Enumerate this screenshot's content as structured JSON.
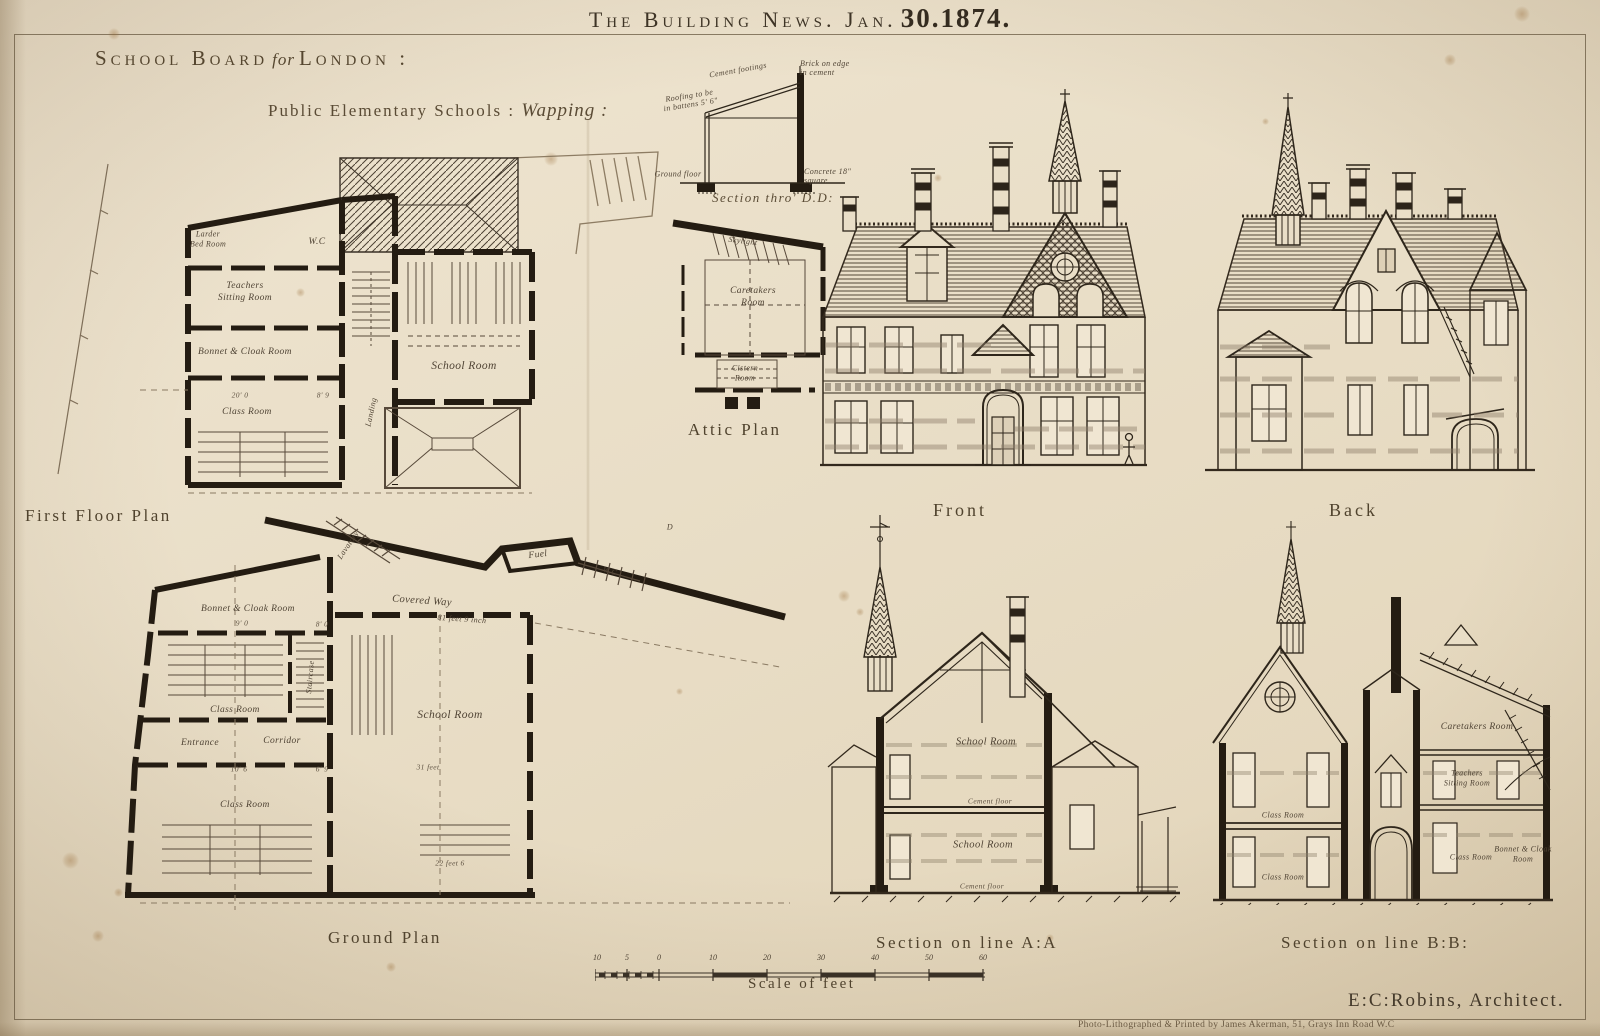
{
  "masthead": {
    "title": "The Building News. Jan.",
    "date": "30.1874."
  },
  "header": {
    "board": "School Board",
    "for_word": "for",
    "city": "London :",
    "schools": "Public Elementary Schools :",
    "place": "Wapping :"
  },
  "first_floor": {
    "caption": "First Floor Plan",
    "rooms": {
      "larder1": "Larder",
      "larder2": "Bed Room",
      "wc": "W.C",
      "teachers1": "Teachers",
      "teachers2": "Sitting Room",
      "bonnet": "Bonnet & Cloak Room",
      "landing": "Landing",
      "school": "School Room",
      "class_room": "Class Room"
    },
    "dims": [
      "20' 0",
      "8' 9"
    ]
  },
  "section_dd": {
    "caption": "Section thro' D.D:",
    "ann_roofing": "Roofing to be in battens 5' 6\"",
    "ann_cement": "Cement footings",
    "ann_brick": "Brick on edge in cement",
    "ann_concrete": "Concrete 18\" square",
    "ann_ground": "Ground floor"
  },
  "attic": {
    "caption": "Attic Plan",
    "rooms": {
      "skylight": "Skylight",
      "caretakers1": "Caretakers",
      "caretakers2": "Room",
      "cistern1": "Cistern",
      "cistern2": "Room"
    }
  },
  "front": {
    "caption": "Front"
  },
  "back": {
    "caption": "Back"
  },
  "ground": {
    "caption": "Ground Plan",
    "rooms": {
      "lavatory": "Lavatory",
      "fuel": "Fuel",
      "wc": "W.C",
      "covered_way": "Covered Way",
      "covered_dim": "81 feet 9 inch",
      "bonnet": "Bonnet & Cloak Room",
      "class_upper": "Class Room",
      "staircase": "Staircase",
      "entrance": "Entrance",
      "corridor": "Corridor",
      "school": "School Room",
      "class_lower": "Class Room",
      "door_marker": "D"
    },
    "dims": [
      "9' 0",
      "8' 0",
      "10' 6",
      "6' 9",
      "31 feet",
      "22 feet 6"
    ]
  },
  "section_aa": {
    "caption": "Section on line A:A",
    "labels": {
      "school_upper": "School Room",
      "cement_upper": "Cement floor",
      "school_lower": "School Room",
      "cement_lower": "Cement floor"
    }
  },
  "section_bb": {
    "caption": "Section on line B:B:",
    "labels": {
      "caretakers": "Caretakers Room",
      "sitting1": "Teachers",
      "sitting2": "Sitting Room",
      "class_upper": "Class Room",
      "class_lower": "Class Room",
      "class_right": "Class Room",
      "bonnet1": "Bonnet & Cloak",
      "bonnet2": "Room"
    }
  },
  "scale": {
    "caption": "Scale of feet",
    "ticks": [
      "10",
      "5",
      "0",
      "10",
      "20",
      "30",
      "40",
      "50",
      "60"
    ]
  },
  "credits": {
    "architect": "E:C:Robins, Architect.",
    "printer": "Photo-Lithographed & Printed by James Akerman, 51, Grays Inn Road  W.C"
  }
}
